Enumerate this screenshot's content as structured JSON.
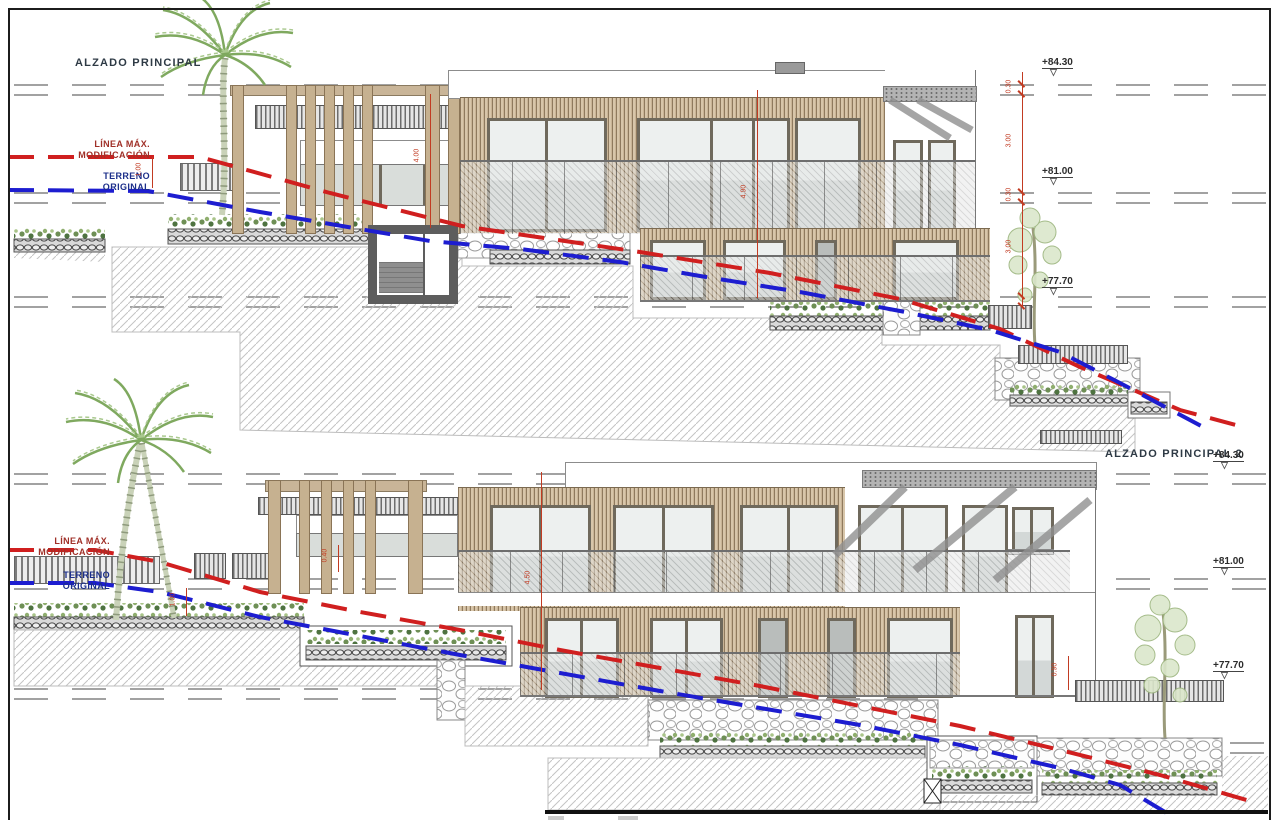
{
  "colors": {
    "red_line": "#d01f1f",
    "blue_line": "#1d1dd0",
    "dim_red": "#c23b22",
    "wood_light": "#d8c6aa",
    "wood_dark": "#8f7a5e"
  },
  "sheet1": {
    "title": "ALZADO PRINCIPAL",
    "max_line_label_1": "LÍNEA MÁX.",
    "max_line_label_2": "MODIFICACIÓN",
    "terrain_label_1": "TERRENO",
    "terrain_label_2": "ORIGINAL",
    "levels": [
      {
        "value": "+84.30"
      },
      {
        "value": "+81.00"
      },
      {
        "value": "+77.70"
      }
    ],
    "levels_triangle": "▽",
    "dims": {
      "d1": "1.00",
      "d2": "4.00",
      "d3": "4.90",
      "chain": [
        "0.30",
        "3.00",
        "0.30",
        "3.00"
      ]
    }
  },
  "sheet2": {
    "title": "ALZADO PRINCIPAL 2",
    "max_line_label_1": "LÍNEA MÁX.",
    "max_line_label_2": "MODIFICACIÓN",
    "terrain_label_1": "TERRENO",
    "terrain_label_2": "ORIGINAL",
    "levels": [
      {
        "value": "+84.30"
      },
      {
        "value": "+81.00"
      },
      {
        "value": "+77.70"
      }
    ],
    "levels_triangle": "▽",
    "dims": {
      "d1": "0.40",
      "d2": "4.50",
      "d3": "0.90",
      "d4": "1.00"
    }
  }
}
